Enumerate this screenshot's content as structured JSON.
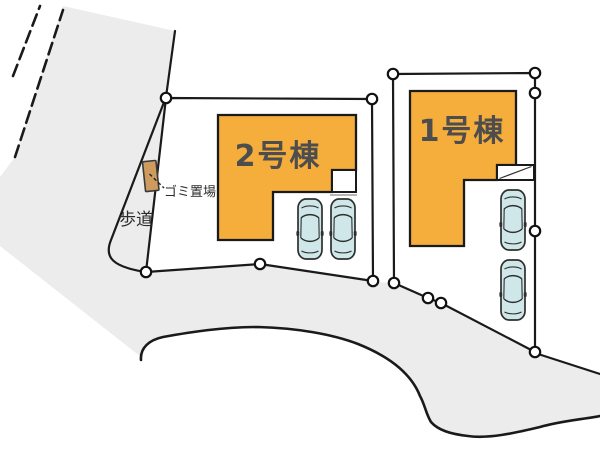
{
  "site_plan": {
    "buildings": [
      {
        "id": 1,
        "label": "1号棟"
      },
      {
        "id": 2,
        "label": "2号棟"
      }
    ],
    "annotations": {
      "garbage_area": "ゴミ置場",
      "sidewalk": "歩道"
    },
    "parking_spaces": 4,
    "boundary_markers": 13,
    "colors": {
      "road": "#ececec",
      "plot": "#ffffff",
      "building": "#f5ae3c",
      "car_body": "#cfe7e9",
      "garbage_box": "#cf9a5e",
      "outline": "#1a1a1a",
      "building_label_text": "#4d4d4d",
      "annotation_text": "#2b2b2b"
    }
  }
}
